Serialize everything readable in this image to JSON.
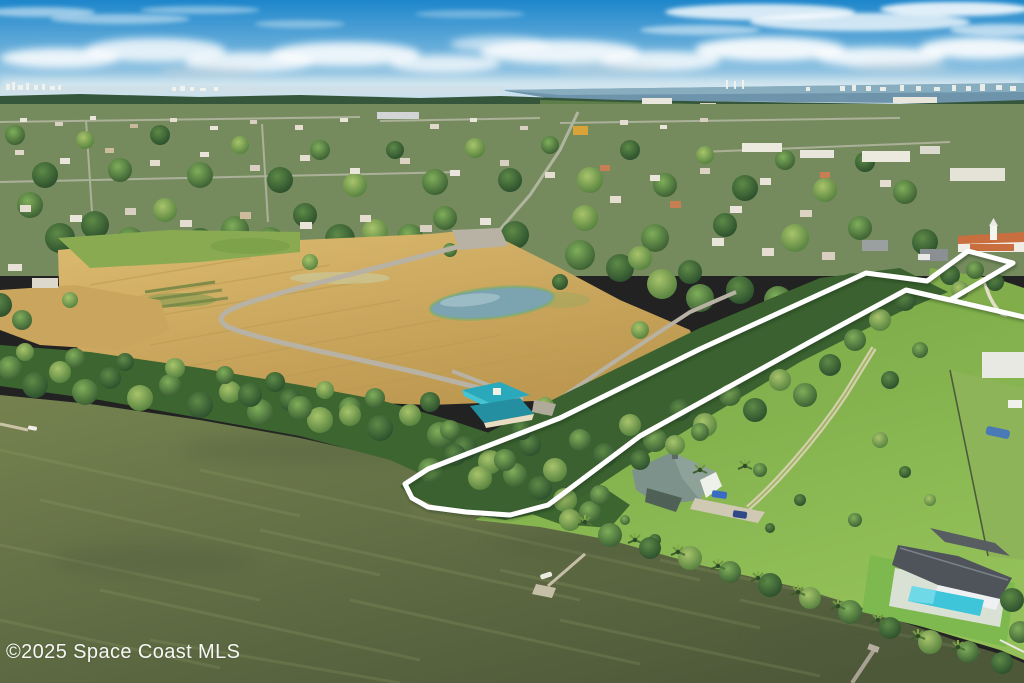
{
  "image": {
    "description": "Aerial drone photo of a waterfront acreage parcel outlined in white, with river, cleared field, tree corridor, lawns, houses and docks"
  },
  "watermark": {
    "text": "©2025 Space Coast MLS"
  },
  "boundary": {
    "color": "#ffffff",
    "stroke_width": 5,
    "points": "405,484 428,469 560,418 700,349 866,273 927,281 968,251 1013,263 950,300 906,290 810,342 640,436 548,505 510,515 466,512 428,507 412,498",
    "spur_points": "950,300 1024,317"
  },
  "palette": {
    "sky_top": "#1d86cb",
    "sky_mid": "#79b7dd",
    "sky_horizon": "#d9e8ef",
    "distant_water": "#6d94ab",
    "far_trees": "#35563b",
    "field_light": "#dcbb70",
    "field_shadow": "#bd9850",
    "pond": "#7ca3b0",
    "road_gray": "#b7b2a4",
    "lawn_light": "#93c058",
    "lawn_dark": "#76a645",
    "water_light": "#75824f",
    "water_dark": "#4d5839",
    "teal_roof": "#2aa9bc",
    "main_house_roof": "#7d928a",
    "pool": "#3ec5d9",
    "modern_roof": "#4e545a"
  }
}
